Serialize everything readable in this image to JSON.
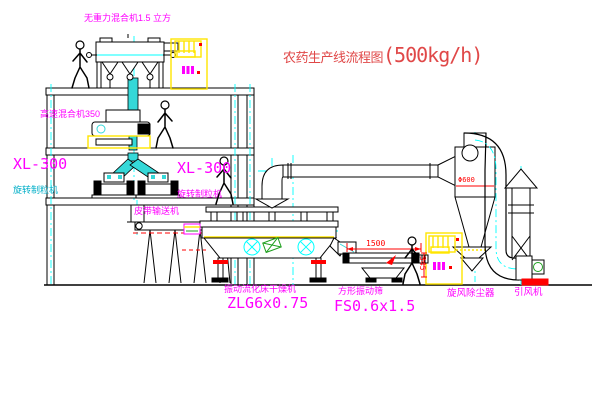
{
  "title": {
    "text": "农药生产线流程图",
    "capacity": "(500kg/h)"
  },
  "labels": {
    "top_mixer": "无重力混合机1.5 立方",
    "high_speed_mixer": "高速混合机350",
    "granulator_left": {
      "model": "XL-300",
      "name": "旋转制粒机"
    },
    "granulator_right": {
      "model": "XL-300",
      "name": "旋转制粒机"
    },
    "belt_conveyor": "皮带输送机",
    "dryer": {
      "name": "振动流化床干燥机",
      "model": "ZLG6x0.75"
    },
    "sieve": {
      "name": "方形振动筛",
      "model": "FS0.6x1.5"
    },
    "cyclone": "旋风除尘器",
    "fan": "引风机"
  },
  "dimensions": {
    "sieve_length": "1500",
    "sieve_height": "345",
    "cyclone_diameter": "Φ600"
  },
  "colors": {
    "mag": "#FF00FF",
    "red": "#FF0000",
    "titlered": "#E04848",
    "cyan": "#00FFFF",
    "pipe": "#35D8D8",
    "yel": "#FFE500",
    "grn": "#1FA01F",
    "teal": "#00AEC7"
  }
}
